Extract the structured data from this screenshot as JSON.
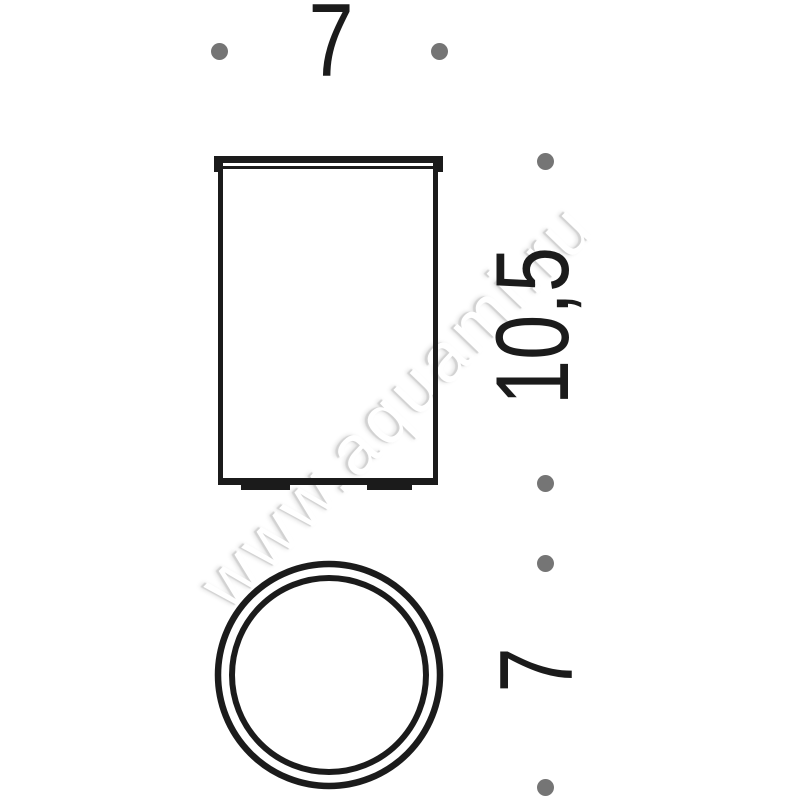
{
  "page": {
    "background": "#ffffff",
    "watermark_text": "www.aquami.ru"
  },
  "drawing": {
    "description": "Two-view technical dimension drawing of a cylindrical tumbler (front elevation and top view)",
    "line_color": "#1b1b1b",
    "dot_color": "#757575",
    "views": {
      "front": {
        "shape": "rectangle-with-rim-and-feet"
      },
      "top": {
        "shape": "double-concentric-circle"
      }
    },
    "dimensions": {
      "width": {
        "label": "7",
        "orientation": "horizontal",
        "applies_to": "front-view-width"
      },
      "height": {
        "label": "10,5",
        "orientation": "vertical-rotated",
        "applies_to": "front-view-height"
      },
      "diameter": {
        "label": "7",
        "orientation": "vertical-rotated",
        "applies_to": "top-view-diameter"
      }
    }
  }
}
